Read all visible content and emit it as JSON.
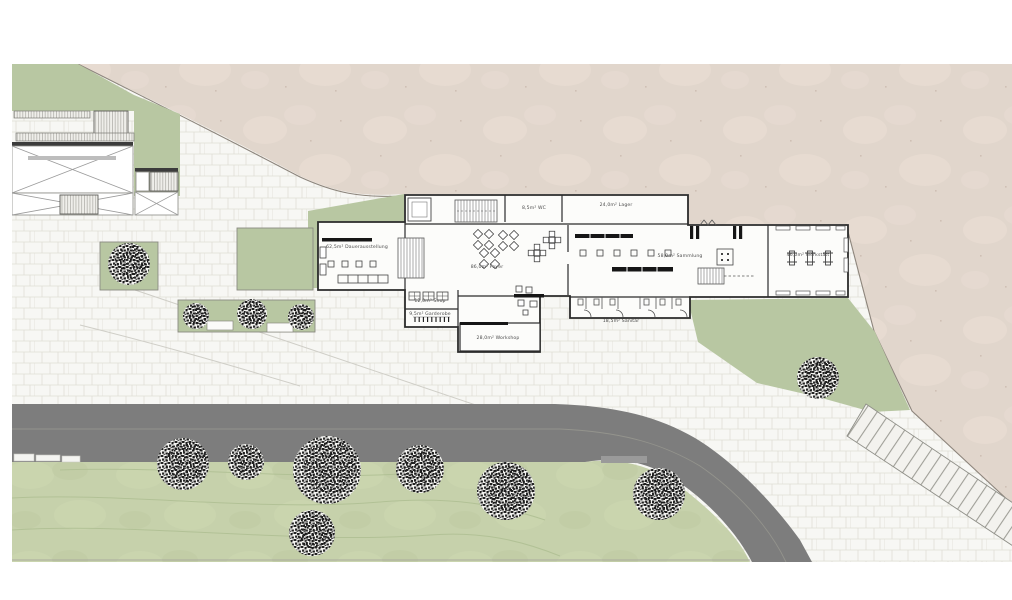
{
  "palette": {
    "page_bg": "#ffffff",
    "hillside": "#e1d6cc",
    "hillside_edge": "#8d857c",
    "grass": "#b8c7a2",
    "lawn": "#c6d1ab",
    "contour": "#b0c094",
    "road": "#7d7d7d",
    "road_line": "#98988f",
    "paving": "#f7f7f4",
    "paving_joint": "#e0ded6",
    "wall": "#2b2b2b",
    "detail": "#555555",
    "black_fixture": "#161616",
    "tree_speckle": "#1c1c1c",
    "label": "#4b4b4b"
  },
  "rooms": [
    {
      "area": "62,5m²",
      "name": "Dauerausstellung",
      "x": 357,
      "y": 248
    },
    {
      "area": "8,5m²",
      "name": "WC",
      "x": 534,
      "y": 209
    },
    {
      "area": "24,0m²",
      "name": "Lager",
      "x": 616,
      "y": 206
    },
    {
      "area": "86,0m²",
      "name": "Foyer",
      "x": 487,
      "y": 268
    },
    {
      "area": "58,0m²",
      "name": "Sammlung",
      "x": 680,
      "y": 257
    },
    {
      "area": "46,0m²",
      "name": "Werkstatt",
      "x": 808,
      "y": 256
    },
    {
      "area": "12,0m²",
      "name": "Shop",
      "x": 430,
      "y": 302
    },
    {
      "area": "9,5m²",
      "name": "Garderobe",
      "x": 430,
      "y": 315
    },
    {
      "area": "28,0m²",
      "name": "Workshop",
      "x": 498,
      "y": 339
    },
    {
      "area": "18,5m²",
      "name": "Sanitär",
      "x": 621,
      "y": 322
    }
  ],
  "trees": [
    {
      "x": 129,
      "y": 264,
      "r": 21
    },
    {
      "x": 196,
      "y": 316,
      "r": 13
    },
    {
      "x": 252,
      "y": 314,
      "r": 15
    },
    {
      "x": 301,
      "y": 317,
      "r": 13
    },
    {
      "x": 818,
      "y": 378,
      "r": 21
    },
    {
      "x": 183,
      "y": 464,
      "r": 26
    },
    {
      "x": 246,
      "y": 462,
      "r": 18
    },
    {
      "x": 327,
      "y": 470,
      "r": 34
    },
    {
      "x": 312,
      "y": 533,
      "r": 23
    },
    {
      "x": 420,
      "y": 469,
      "r": 24
    },
    {
      "x": 506,
      "y": 491,
      "r": 29
    },
    {
      "x": 659,
      "y": 494,
      "r": 26
    }
  ]
}
